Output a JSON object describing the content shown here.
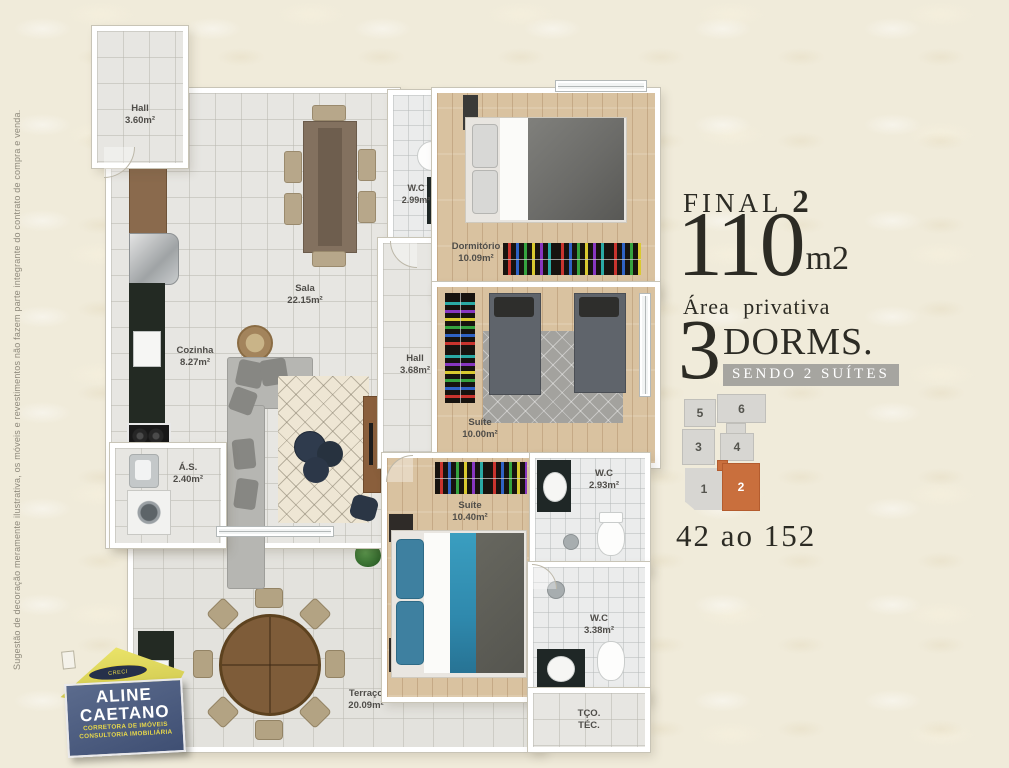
{
  "disclaimer": "Sugestão de decoração meramente ilustrativa, os móveis e revestimentos não fazem parte integrante do contrato de compra e venda.",
  "rooms": {
    "hall_entry": {
      "name": "Hall",
      "area": "3.60m²"
    },
    "wc_social": {
      "name": "W.C",
      "area": "2.99m²"
    },
    "dormitorio": {
      "name": "Dormitório",
      "area": "10.09m²"
    },
    "sala": {
      "name": "Sala",
      "area": "22.15m²"
    },
    "cozinha": {
      "name": "Cozinha",
      "area": "8.27m²"
    },
    "hall_intimo": {
      "name": "Hall",
      "area": "3.68m²"
    },
    "suite_1": {
      "name": "Suíte",
      "area": "10.00m²"
    },
    "area_servico": {
      "name": "Á.S.",
      "area": "2.40m²"
    },
    "suite_2": {
      "name": "Suíte",
      "area": "10.40m²"
    },
    "wc_suite": {
      "name": "W.C",
      "area": "2.93m²"
    },
    "wc_terraco": {
      "name": "W.C",
      "area": "3.38m²"
    },
    "terraco": {
      "name": "Terraço",
      "area": "20.09m²"
    },
    "tco_tec": {
      "line1": "TÇO.",
      "line2": "TÉC."
    }
  },
  "info_panel": {
    "final_label": "FINAL",
    "final_number": "2",
    "area_number": "110",
    "area_unit": "m2",
    "area_caption": "Área privativa",
    "dorms_number": "3",
    "dorms_label": "DORMS.",
    "suites_banner": "SENDO 2 SUÍTES",
    "units_range": "42 ao 152",
    "unit_map": {
      "units": [
        "5",
        "6",
        "3",
        "4",
        "1",
        "2"
      ],
      "highlighted_unit": "2",
      "highlight_color": "#c96f3d",
      "block_color": "#d7d6d2"
    }
  },
  "logo": {
    "creci": "CRECI",
    "name_line1": "ALINE",
    "name_line2": "CAETANO",
    "subtitle1": "CORRETORA DE IMÓVEIS",
    "subtitle2": "CONSULTORIA IMOBILIÁRIA"
  },
  "colors": {
    "background": "#f0ebda",
    "ink": "#2c2b24",
    "banner_gray": "#a6a5a0",
    "highlight_orange": "#c96f3d"
  }
}
